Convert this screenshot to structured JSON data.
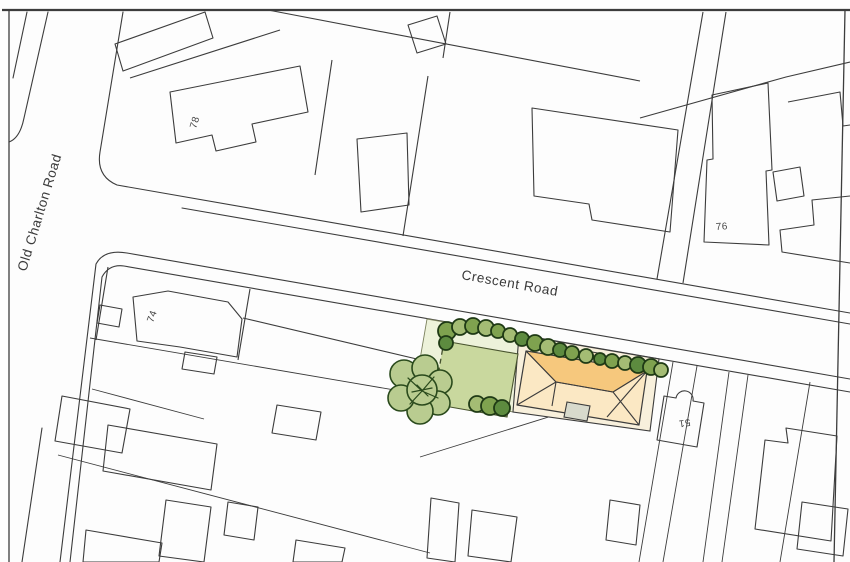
{
  "map": {
    "type": "site-location-plan",
    "labels": {
      "old_charlton_road": "Old Charlton Road",
      "crescent_road": "Crescent Road",
      "house_78": "78",
      "house_76": "76",
      "house_74": "74",
      "house_51": "51"
    },
    "colors": {
      "line": "#3c3c3c",
      "site-pale": "#edf2da",
      "site-lawn": "#c9d89e",
      "site-cream": "#f8f0dc",
      "roof-dark": "#f6c87d",
      "roof-light": "#fbe8c4",
      "porch": "#d8dacc",
      "tree-fill": "#b9cc90",
      "tree-line": "#2a4a1c",
      "tree-dark": "#1f3a15",
      "bush-a": "#7fa24f",
      "bush-b": "#a4bc74",
      "bush-c": "#5d8b3f"
    }
  }
}
